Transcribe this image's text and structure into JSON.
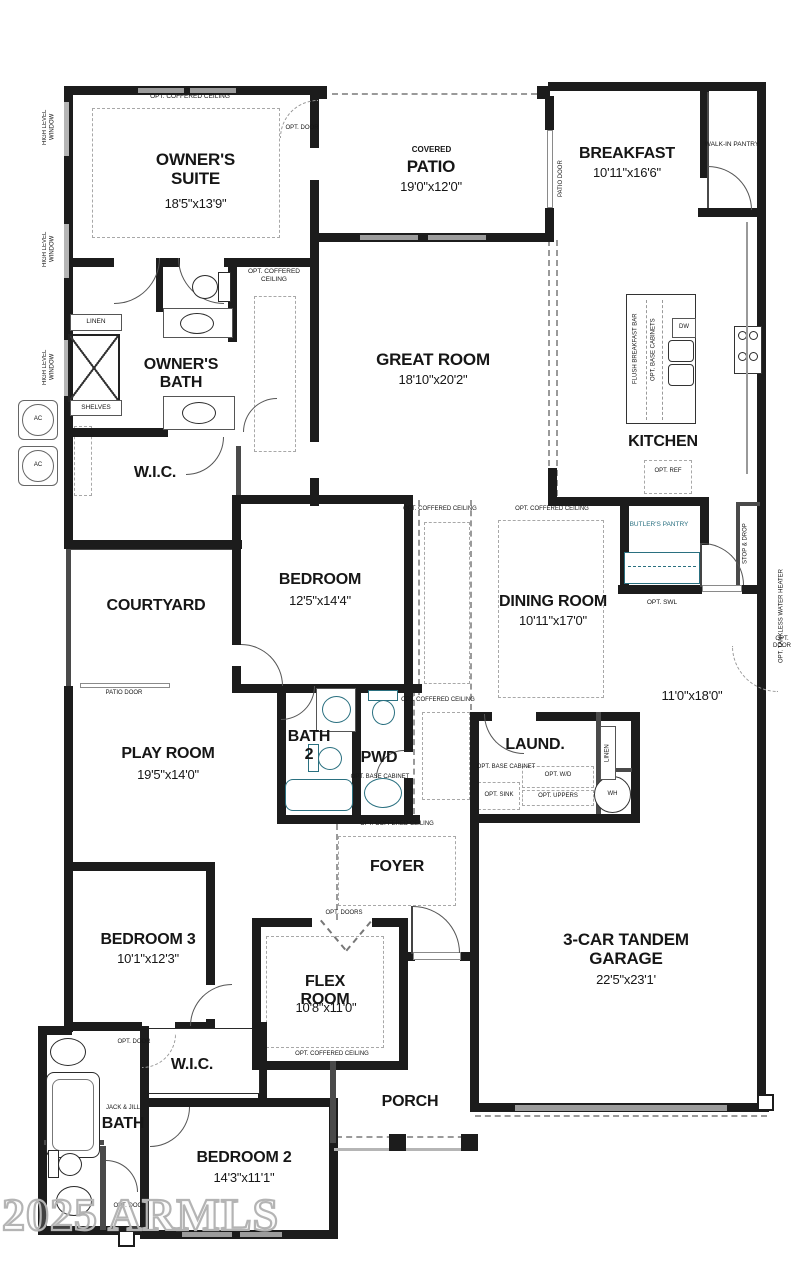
{
  "watermark": "2025 ARMLS",
  "colors": {
    "wall": "#1c1c1c",
    "teal": "#2a7080",
    "dash": "#a8a8a8",
    "watermark": "#b4b4b4"
  },
  "rooms": {
    "owners_suite": {
      "name": "OWNER'S SUITE",
      "dims": "18'5\"x13'9\""
    },
    "patio": {
      "sub": "COVERED",
      "name": "PATIO",
      "dims": "19'0\"x12'0\""
    },
    "breakfast": {
      "name": "BREAKFAST",
      "dims": "10'11\"x16'6\""
    },
    "walk_in_pantry": {
      "name": "WALK-IN PANTRY"
    },
    "great_room": {
      "name": "GREAT ROOM",
      "dims": "18'10\"x20'2\""
    },
    "kitchen": {
      "name": "KITCHEN"
    },
    "owners_bath": {
      "name": "OWNER'S BATH"
    },
    "wic_owners": {
      "name": "W.I.C."
    },
    "courtyard": {
      "name": "COURTYARD"
    },
    "bedroom": {
      "name": "BEDROOM",
      "dims": "12'5\"x14'4\""
    },
    "dining_room": {
      "name": "DINING ROOM",
      "dims": "10'11\"x17'0\""
    },
    "butlers_pantry": {
      "name": "BUTLER'S PANTRY"
    },
    "play_room": {
      "name": "PLAY ROOM",
      "dims": "19'5\"x14'0\""
    },
    "bath2": {
      "name": "BATH 2"
    },
    "pwd": {
      "name": "PWD"
    },
    "laundry": {
      "name": "LAUND."
    },
    "foyer": {
      "name": "FOYER"
    },
    "flex_room": {
      "name": "FLEX ROOM",
      "dims": "10'8\"x11'0\""
    },
    "bedroom3": {
      "name": "BEDROOM 3",
      "dims": "10'1\"x12'3\""
    },
    "wic2": {
      "name": "W.I.C."
    },
    "jack_jill_bath": {
      "sub": "JACK & JILL",
      "name": "BATH"
    },
    "bedroom2": {
      "name": "BEDROOM 2",
      "dims": "14'3\"x11'1\""
    },
    "porch": {
      "name": "PORCH"
    },
    "garage": {
      "name": "3-CAR TANDEM GARAGE",
      "dims": "22'5\"x23'1'",
      "tandem_dims": "11'0\"x18'0\""
    }
  },
  "annotations": {
    "opt_coffered_ceiling": "OPT. COFFERED CEILING",
    "opt_door": "OPT. DOOR",
    "opt_doors": "OPT. DOORS",
    "patio_door": "PATIO DOOR",
    "high_level_window": "HIGH LEVEL WINDOW",
    "linen": "LINEN",
    "shelves": "SHELVES",
    "ac": "AC",
    "wh": "WH",
    "dw": "DW",
    "flush_breakfast_bar": "FLUSH BREAKFAST BAR",
    "opt_base_cabinets": "OPT. BASE CABINETS",
    "opt_base_cabinet": "OPT. BASE CABINET",
    "opt_ref": "OPT. REF",
    "opt_swl": "OPT. SWL",
    "stop_and_drop": "STOP & DROP",
    "opt_tankless_water_heater": "OPT. TANKLESS WATER HEATER",
    "opt_sink": "OPT. SINK",
    "opt_wd": "OPT. W/D",
    "opt_uppers": "OPT. UPPERS"
  }
}
